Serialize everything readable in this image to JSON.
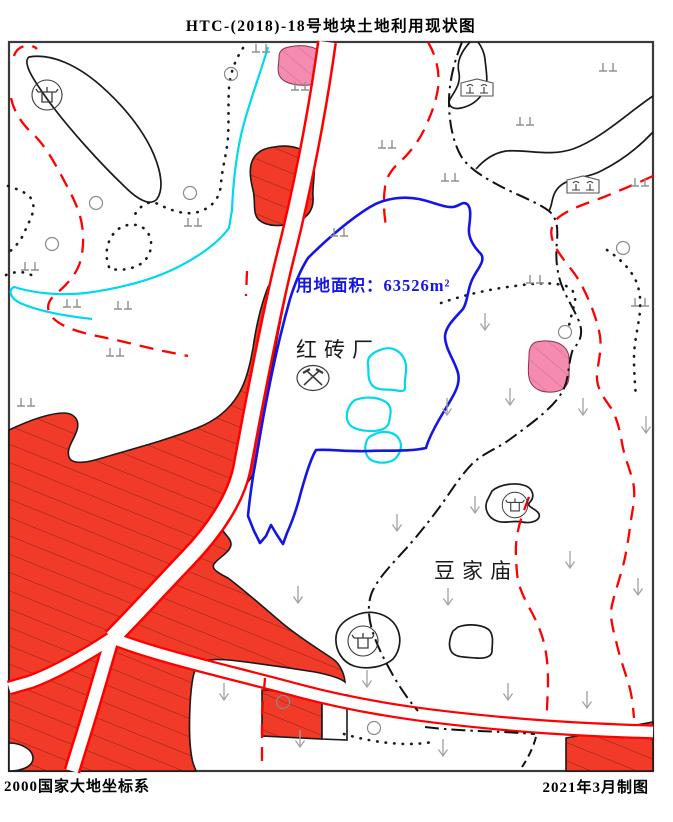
{
  "title": "HTC-(2018)-18号地块土地利用现状图",
  "map": {
    "parcel": {
      "area_label": "用地面积：63526m²",
      "boundary_color": "#1515e8"
    },
    "labels": {
      "brick_factory": "红砖厂",
      "temple_village": "豆家庙"
    },
    "colors": {
      "construction_red": "#f13a28",
      "pink_area": "#f58bb0",
      "water_cyan": "#00d8ee",
      "road_edge_red": "#ff0000",
      "outline_black": "#1a1a1a",
      "symbol_gray": "#909090"
    },
    "symbols": [
      "temple-icon",
      "mine-icon",
      "greenhouse-icon",
      "grass-icon",
      "scrub-arrow-icon",
      "circle-marker-icon"
    ]
  },
  "footer": {
    "left": "2000国家大地坐标系",
    "right": "2021年3月制图"
  }
}
